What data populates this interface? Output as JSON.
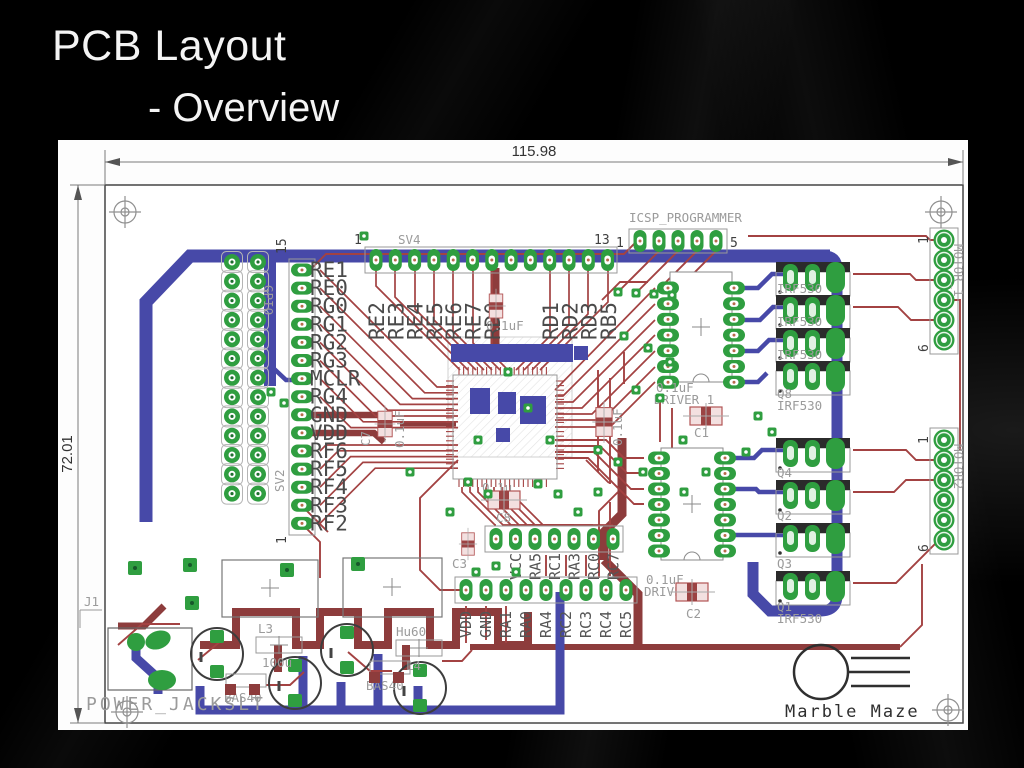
{
  "slide": {
    "title": "PCB Layout",
    "subtitle": "- Overview"
  },
  "dimensions": {
    "width": "115.98",
    "height": "72.01"
  },
  "silk": {
    "icsp": "ICSP_PROGRAMMER",
    "icsp_pin_first": "1",
    "icsp_pin_last": "5",
    "sv4": "SV4",
    "sv4_pin_first": "1",
    "sv4_pin_last": "13",
    "sv4_labels_left": [
      "RE2",
      "RE3",
      "RE4",
      "RE5",
      "RE6",
      "RE7",
      "RD0"
    ],
    "sv4_labels_right": [
      "RD1",
      "RD2",
      "RD3",
      "RB5"
    ],
    "gpio": "GPIO",
    "sv2": "SV2",
    "sv2_pin_top": "15",
    "sv2_pin_bottom": "1",
    "sv2_labels": [
      "RE1",
      "RE0",
      "RG0",
      "RG1",
      "RG2",
      "RG3",
      "MCLR",
      "RG4",
      "GND",
      "VDD",
      "RF6",
      "RF5",
      "RF4",
      "RF3",
      "RF2"
    ],
    "c7": "C7",
    "c7_value": "0.1uF",
    "top_cap_value": "0.1uF",
    "center_cap_value": "0.1u",
    "right_cap_value": "0.1uF",
    "driver1": "DRIVER_1",
    "driver1_cap": "0.1uF",
    "c1": "C1",
    "driver2": "DRIVER_2",
    "driver2_cap": "0.1uF",
    "c2": "C2",
    "q8": "Q8",
    "q8_part": "IRF530",
    "bank1_parts": [
      "IRF530",
      "IRF530",
      "IRF530"
    ],
    "q4": "Q4",
    "q2": "Q2",
    "q3": "Q3",
    "q1": "Q1",
    "q1_part": "IRF530",
    "motor1": "MOTOR_1",
    "motor2": "MOTOR2",
    "motor_pin_first": "1",
    "motor_pin_last": "6",
    "row_top_labels": [
      "VCC",
      "RA5",
      "RC1",
      "RA3",
      "RC0",
      "RC7"
    ],
    "row_bottom_labels": [
      "VDD",
      "GND",
      "RA1",
      "RA0",
      "RA4",
      "RC2",
      "RC3",
      "RC4",
      "RC5"
    ],
    "c8": "C8",
    "c3": "C3",
    "j1": "J1",
    "power_jack": "POWER_JACKSLT",
    "l3": "L3",
    "l3_value": "100u",
    "bas40_a": "BAS40",
    "bas40_b": "BAS40",
    "hu": "Hu60",
    "l4": "L4"
  },
  "logo": {
    "text": "Marble Maze"
  }
}
